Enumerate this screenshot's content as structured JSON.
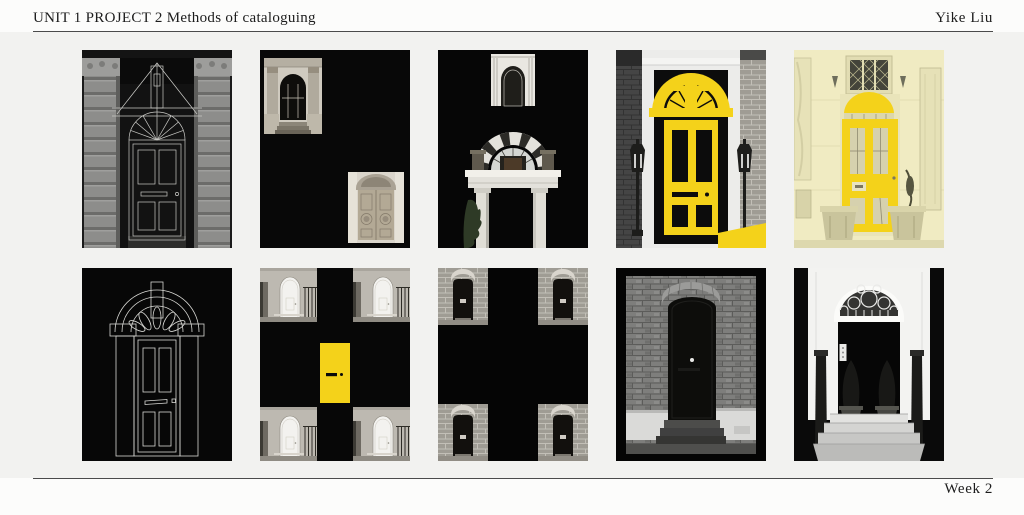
{
  "page": {
    "background": "#fcfcfb",
    "content_background": "#f2f2f0",
    "rule_color": "#4b4b4b"
  },
  "header": {
    "title": "UNIT 1 PROJECT 2 Methods of cataloguing",
    "author": "Yike Liu"
  },
  "footer": {
    "week": "Week 2"
  },
  "colors": {
    "accent_yellow": "#f4d21a",
    "artwork_black": "#070707"
  },
  "gallery": {
    "rows": 2,
    "columns": 5,
    "tiles": [
      {
        "id": 1,
        "name": "columned-doorway-line-overlay",
        "description": "Black and white photograph of a doorway between two banded columns, overlaid with a white geometric line drawing of a fanlight door"
      },
      {
        "id": 2,
        "name": "two-door-photos-on-black",
        "description": "Two small black and white door photographs collaged top-left and bottom-right on a black field"
      },
      {
        "id": 3,
        "name": "stacked-door-totem",
        "description": "Cut-out white architectural door elements stacked into a totem on a black field"
      },
      {
        "id": 4,
        "name": "yellow-door-diagram-over-photo",
        "description": "Bold yellow door and fanlight diagram overlaid on a black and white photograph of a town-house entrance with lanterns"
      },
      {
        "id": 5,
        "name": "yellow-tinted-entrance",
        "description": "Pale yellow tinted photograph of a house entrance with planters, the door picked out in solid yellow"
      },
      {
        "id": 6,
        "name": "white-line-door-drawing",
        "description": "White outline drawing of a panelled door with fanlight and pilasters on a black field"
      },
      {
        "id": 7,
        "name": "four-corners-yellow-centre",
        "description": "Four identical white-door photographs in the corners of a black field with a small solid yellow door at the centre"
      },
      {
        "id": 8,
        "name": "four-corners-black-cross",
        "description": "Four identical brick-doorway photographs in the corners separated by a black cross"
      },
      {
        "id": 9,
        "name": "black-door-in-brick-wall",
        "description": "Black and white photograph of a dark door in a brick wall with steps, inside a black frame"
      },
      {
        "id": 10,
        "name": "blacked-out-georgian-entrance",
        "description": "White Georgian entrance with circular fanlight, topiary and steps, door and sides blacked out"
      }
    ]
  }
}
